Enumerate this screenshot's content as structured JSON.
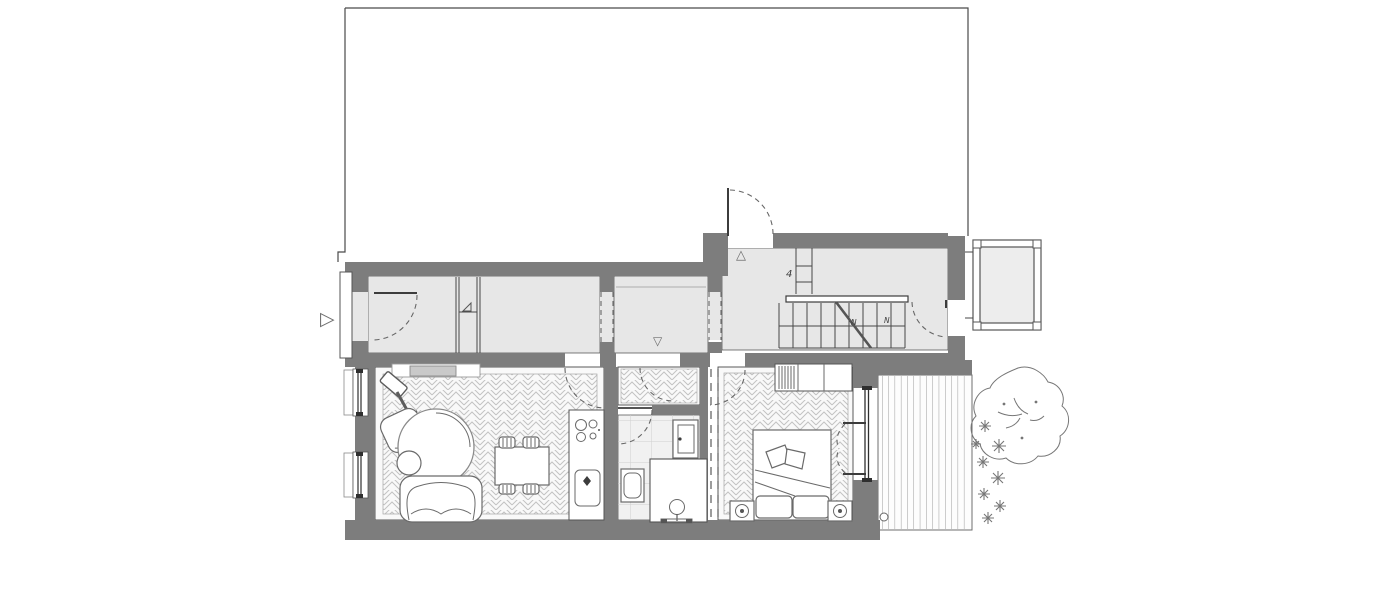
{
  "plan": {
    "title": "apartment-ground-floor-plan",
    "annotations": {
      "stair_flight_count": "4",
      "stair_mark_left": "N",
      "stair_mark_right": "N"
    },
    "markers": {
      "entry_arrow": "▷",
      "threshold_up": "△",
      "threshold_down": "▽"
    },
    "colors": {
      "wall": "#7d7d7d",
      "floor": "#e7e7e7",
      "parquet_bg": "#f9f9f9",
      "parquet_line": "#c3c3c3",
      "tile_bg": "#f1f1f1",
      "tile_line": "#d0d0d0",
      "deck_line": "#9b9b9b",
      "outline": "#474747",
      "furniture": "#6a6a6a",
      "dash": "#666666",
      "plant": "#767676",
      "radiator": "#c9c9c9",
      "glass": "#2f2f2f"
    }
  }
}
